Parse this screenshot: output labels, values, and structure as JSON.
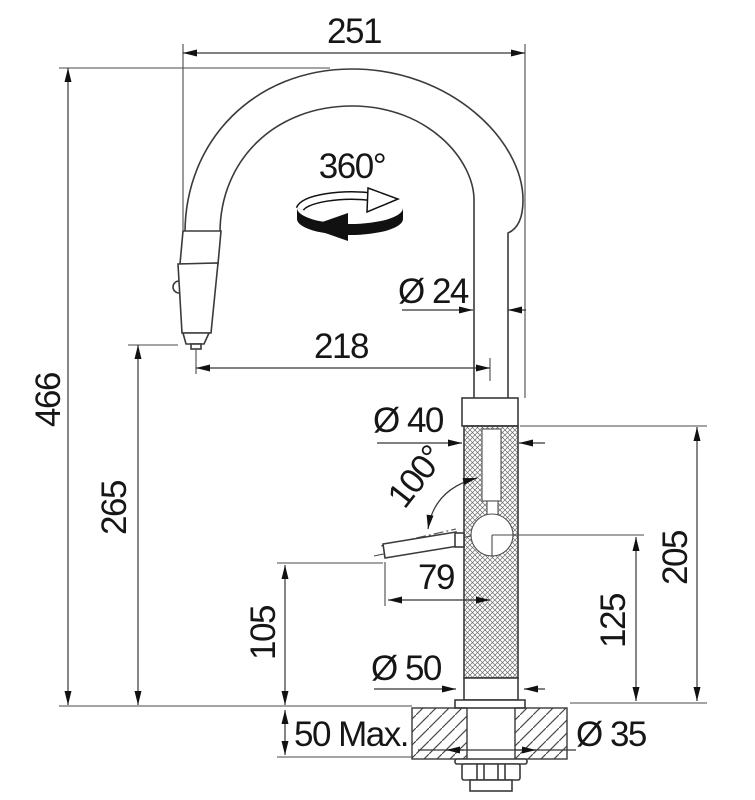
{
  "drawing": {
    "title": "faucet-installation-dimension-drawing",
    "units_note": "mm",
    "labels": {
      "top_width": "251",
      "swivel_angle": "360°",
      "spout_tube_diameter": "Ø 24",
      "spout_reach": "218",
      "total_height": "466",
      "outlet_height": "265",
      "body_diameter": "Ø 40",
      "handle_swing_angle": "100°",
      "handle_length": "79",
      "handle_clearance": "105",
      "handle_axis_height": "125",
      "body_height": "205",
      "base_diameter": "Ø 50",
      "counter_thickness": "50 Max.",
      "hole_diameter": "Ø 35"
    },
    "icons": {
      "rotation": "rotation-360-icon"
    },
    "colors": {
      "line": "#3a3a3a",
      "dimension": "#353535",
      "text": "#161616",
      "fill_black": "#111111",
      "background": "#ffffff"
    }
  }
}
